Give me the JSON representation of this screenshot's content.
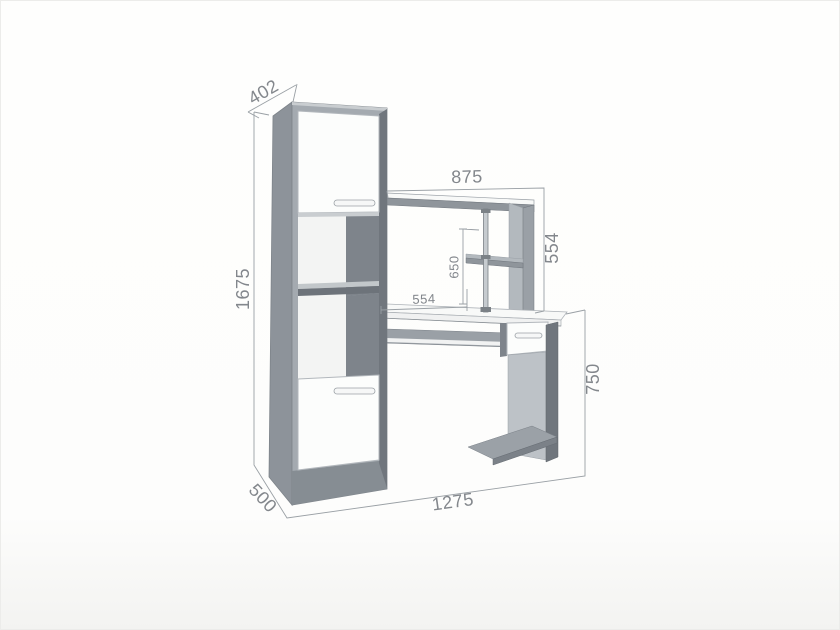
{
  "diagram": {
    "kind": "furniture-dimension-drawing",
    "subject": "computer-desk-with-shelving-column"
  },
  "dims": {
    "cabinet_depth_top": "402",
    "cabinet_height": "1675",
    "cabinet_depth_bottom": "500",
    "hutch_width": "875",
    "hutch_height": "554",
    "monitor_shelf_height": "650",
    "desk_depth": "554",
    "desk_height": "750",
    "overall_width": "1275"
  },
  "colors": {
    "background": "#fdfdfc",
    "dim_line": "#9aa0a5",
    "dim_text": "#83878c",
    "gray_side": "#8d939a",
    "gray_frame": "#a4aab0",
    "gray_plinth": "#868d93",
    "gray_dark": "#70767d",
    "gray_dark2": "#7b8188",
    "gray_int": "#7e848b",
    "gray_mid": "#8f959b",
    "gray_mid2": "#9aa0a6",
    "gray_mid3": "#9ba1a7",
    "gray_shelf": "#6d737a",
    "gray_shelf_top": "#c2c7ca",
    "gray_light": "#b3b9be",
    "gray_light2": "#bdc2c7",
    "white_door": "#fcfdfc",
    "white_int": "#f3f4f3",
    "white_top": "#f8f9f8",
    "white_face": "#f0f1f1",
    "door_edge": "#b2b7bc",
    "top_sliver": "#c9cdd0",
    "pole": "#c6cbcf",
    "pole_edge": "#7b8186",
    "handle_fill": "#f6f7f7",
    "handle_edge": "#9ba1a6"
  }
}
